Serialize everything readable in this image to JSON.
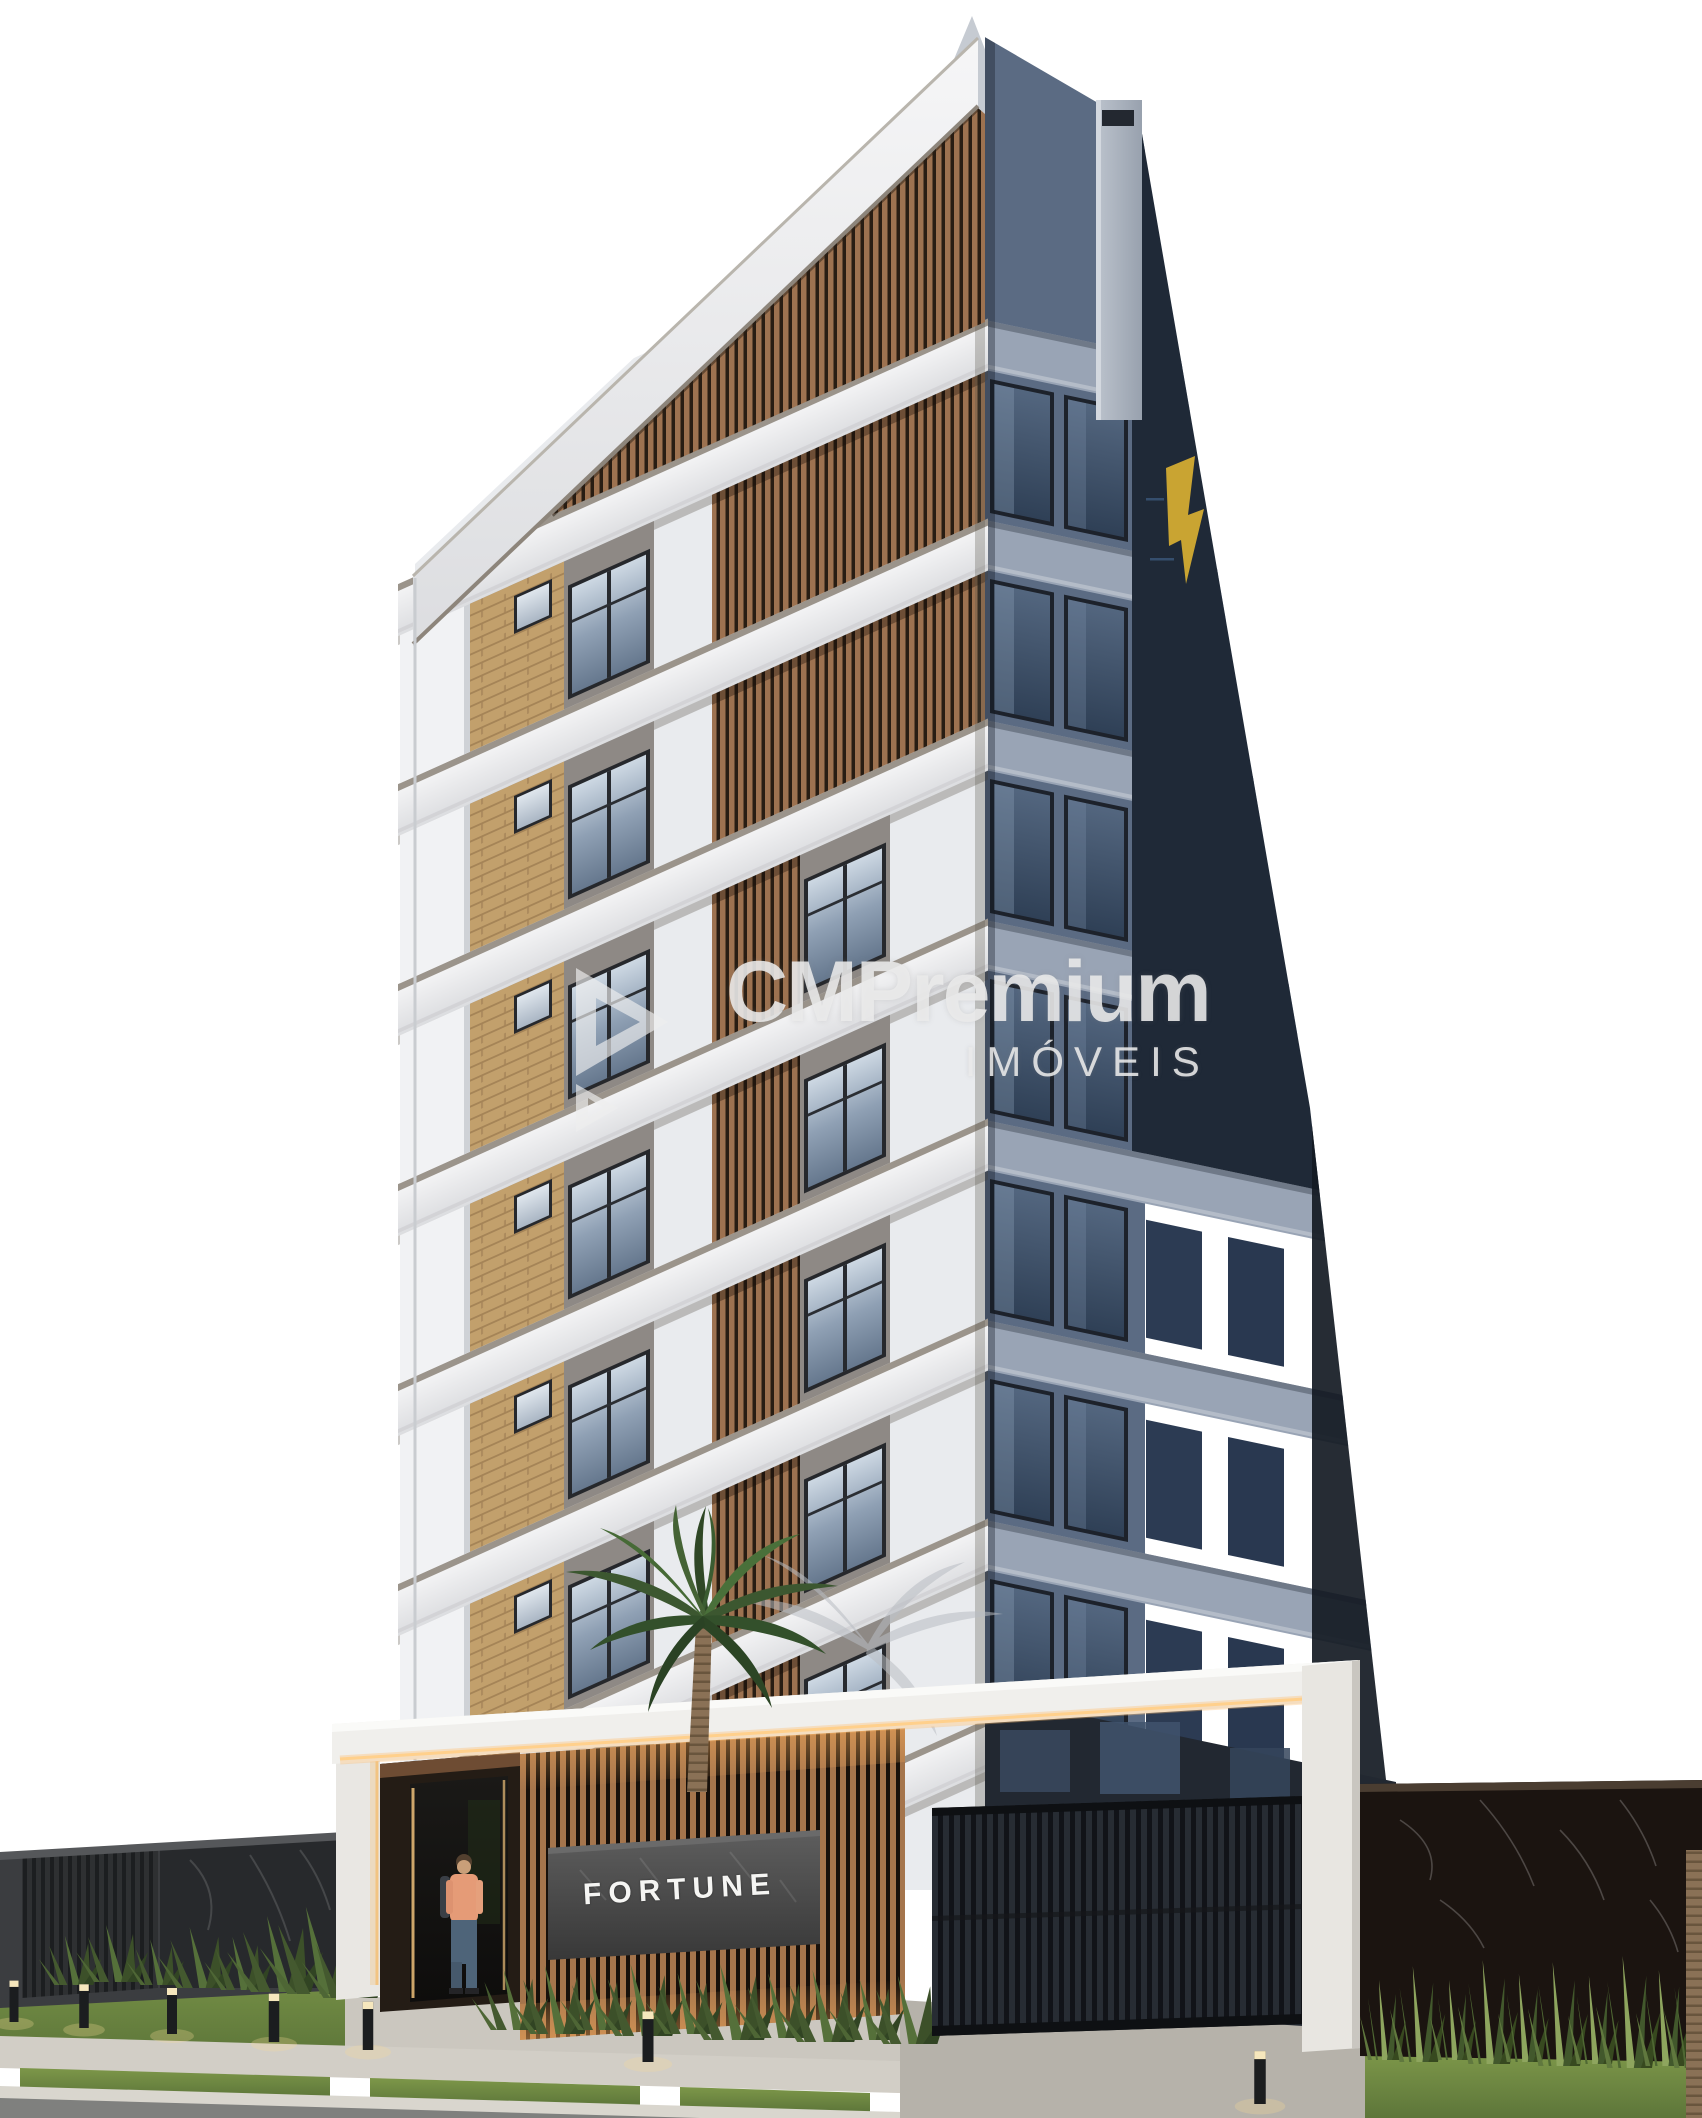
{
  "watermark": {
    "brand": "CMPremium",
    "subtitle": "IMÓVEIS",
    "logo": "cm-premium-play-logo"
  },
  "sign": {
    "text": "FORTUNE"
  },
  "colors": {
    "background": "#ffffff",
    "facade_white": "#e9ebee",
    "facade_brick": "#c2a06c",
    "facade_wood_slat": "#9d7250",
    "facade_right_light": "#5b6b83",
    "facade_right_navy": "#1f2937",
    "accent_gold_logo": "#c9a432",
    "entrance_wood": "#a5754c",
    "warm_light": "#ffd08c",
    "sign_panel": "#4a4a4a",
    "sign_text": "#f5f5f3",
    "gate_black": "#111318",
    "marble_black": "#1b1410",
    "grass": "#68813d",
    "sidewalk": "#d2cec6",
    "asphalt": "#7f807e"
  }
}
